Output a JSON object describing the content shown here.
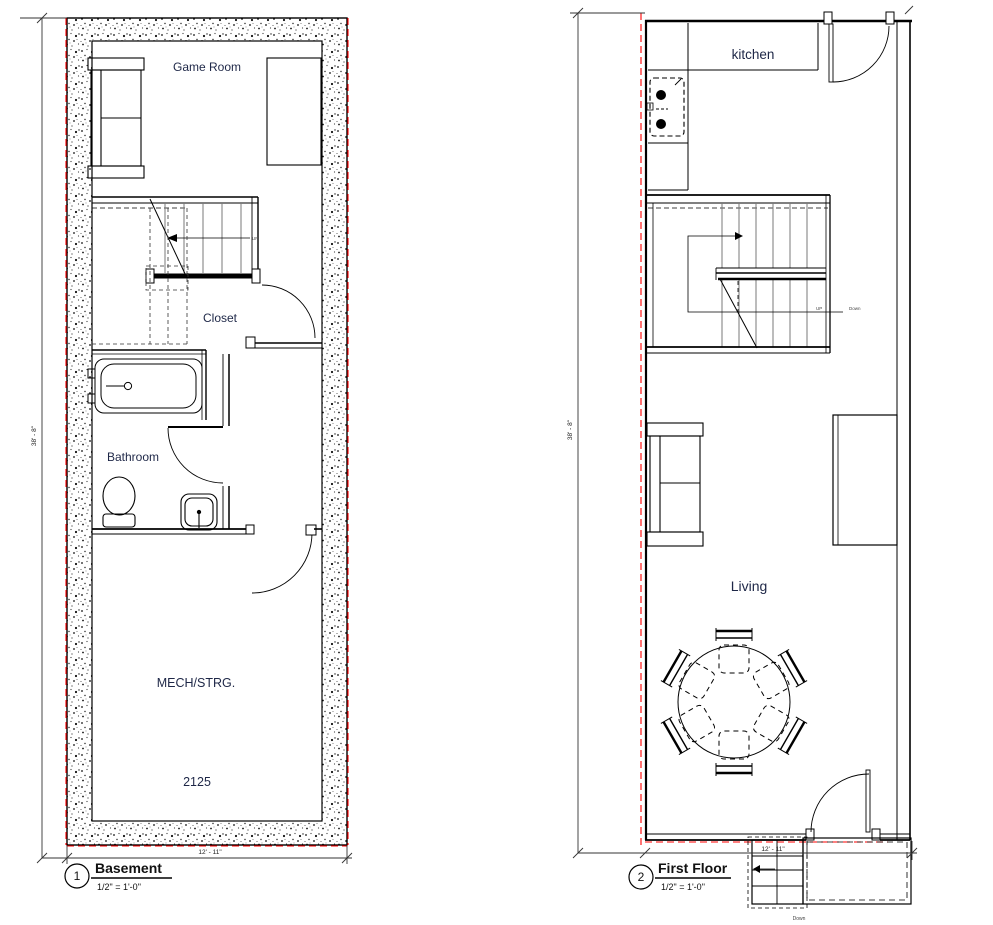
{
  "drawing": {
    "type": "architectural floor plan, two sheets",
    "background_color": "#ffffff",
    "line_color": "#000000",
    "boundary_line_color": "#ff0000",
    "room_label_color": "#1e2747"
  },
  "basement": {
    "callout_number": "1",
    "title": "Basement",
    "scale": "1/2\" = 1'-0\"",
    "rooms": {
      "game_room": "Game Room",
      "closet": "Closet",
      "bathroom": "Bathroom",
      "mech": "MECH/STRG."
    },
    "area_number": "2125",
    "stair_up_label": "UP",
    "dim_width": "12' - 11\"",
    "dim_height": "38' - 8\""
  },
  "first_floor": {
    "callout_number": "2",
    "title": "First Floor",
    "scale": "1/2\" = 1'-0\"",
    "rooms": {
      "kitchen": "kitchen",
      "living": "Living"
    },
    "stair_up_label": "UP",
    "stair_down_label": "Down",
    "exterior_stair_down_label": "Down",
    "dim_width": "12' - 11\"",
    "dim_height": "38' - 8\""
  }
}
